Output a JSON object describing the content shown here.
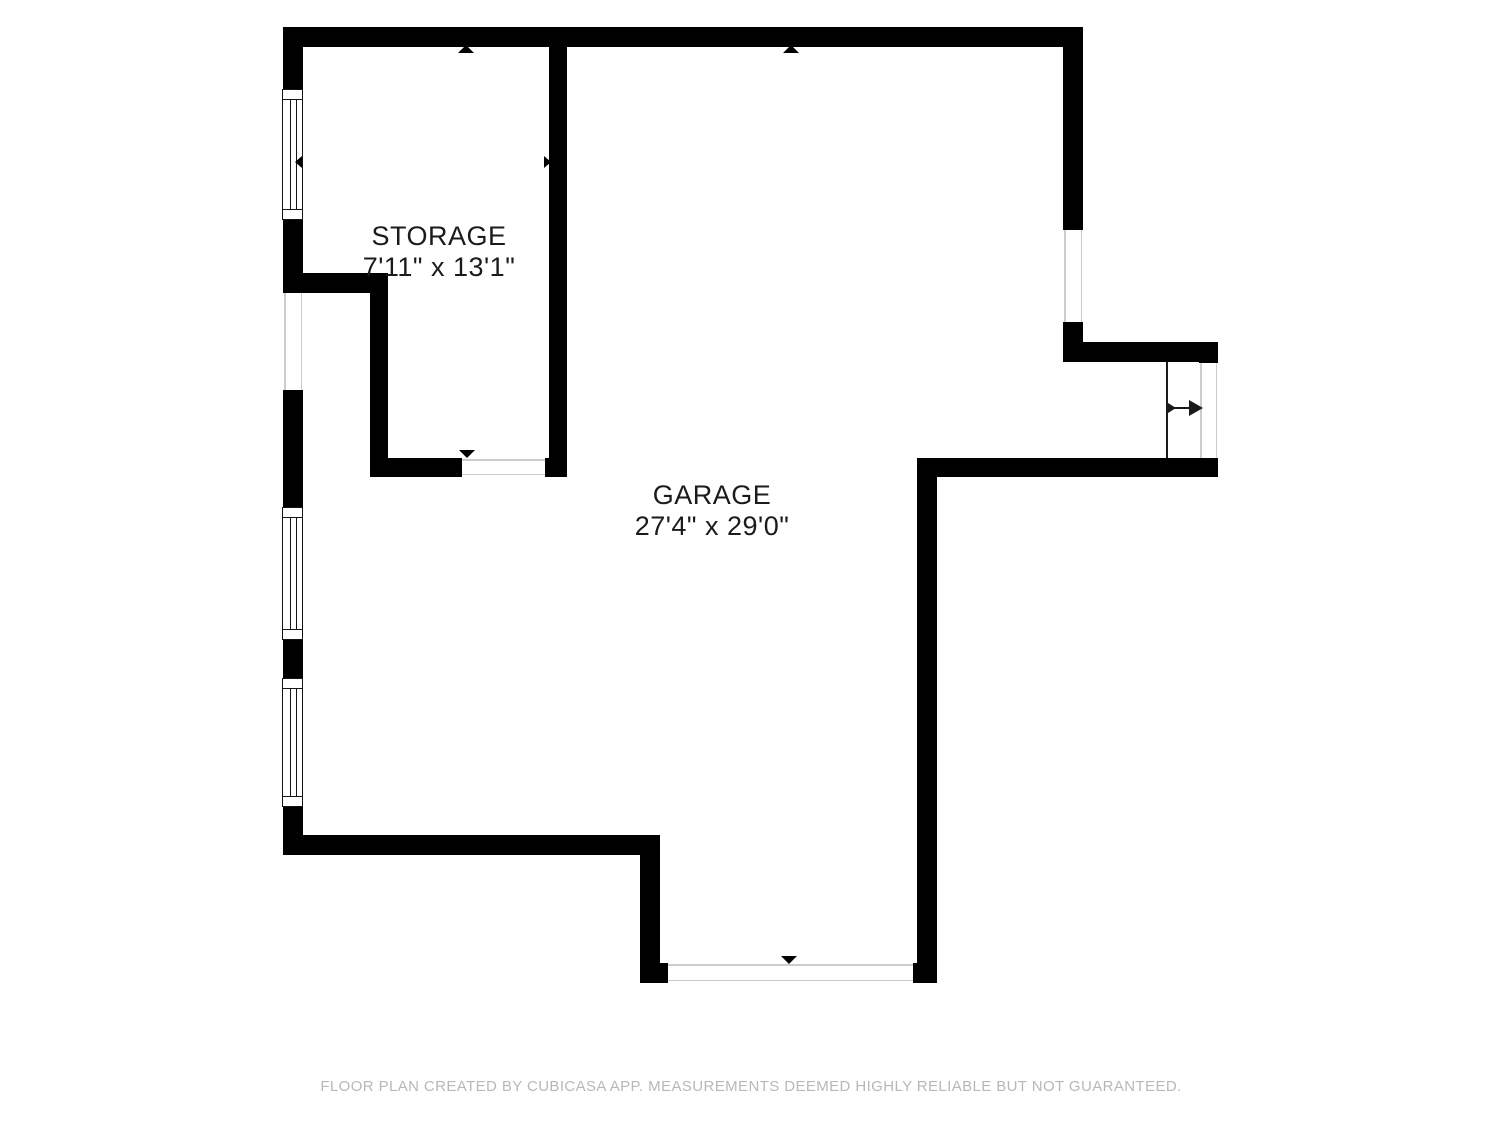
{
  "floorplan": {
    "rooms": [
      {
        "name": "STORAGE",
        "dimensions": "7'11\" x 13'1\""
      },
      {
        "name": "GARAGE",
        "dimensions": "27'4\" x 29'0\""
      }
    ],
    "footer_disclaimer": "FLOOR PLAN CREATED BY CUBICASA APP. MEASUREMENTS DEEMED HIGHLY RELIABLE BUT NOT GUARANTEED.",
    "colors": {
      "wall": "#000000",
      "room_text": "#1b1b1b",
      "footer_text": "#b8b8b8",
      "opening_line": "#cccccc",
      "door_line": "#1a1a1a",
      "background": "#ffffff"
    },
    "icons": {
      "measure_arrow_up": "triangle-up",
      "measure_arrow_down": "triangle-down",
      "measure_arrow_left": "triangle-left",
      "measure_arrow_right": "triangle-right",
      "door_direction_arrow": "arrow-right"
    }
  }
}
